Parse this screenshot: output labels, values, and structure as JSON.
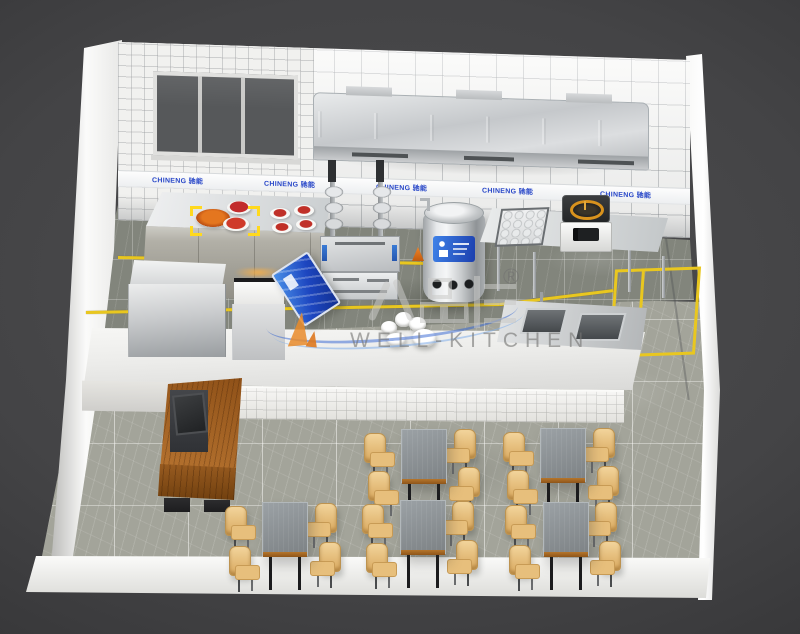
{
  "meta": {
    "title": "Commercial kitchen 3D floor plan render",
    "scene": "fast-food restaurant kitchen and dining area, isometric cutaway view"
  },
  "branding": {
    "watermark_text": "WELL-KITCHEN",
    "registered_mark": "®",
    "equipment_brand": "CHINENG 驰能",
    "wall_banners": [
      {
        "label": "CHINENG 驰能"
      },
      {
        "label": "CHINENG 驰能"
      },
      {
        "label": "CHINENG 驰能"
      },
      {
        "label": "CHINENG 驰能"
      },
      {
        "label": "CHINENG 驰能"
      }
    ]
  },
  "colors": {
    "background": "#404042",
    "wall_tile": "#f3f3f1",
    "kitchen_floor": "#82857c",
    "dining_floor": "#a3a49a",
    "floor_marking_yellow": "#e9c71f",
    "stainless_steel": "#d3d5d7",
    "table_top_gray": "#8b8f93",
    "chair_wood": "#e9c387",
    "cashier_wood": "#9a5c28",
    "brand_blue": "#2746c8",
    "label_blue": "#2b6be0"
  },
  "inventory": {
    "dining_tables": 5,
    "chairs_per_table": 4,
    "wall_banner_count": 5
  }
}
